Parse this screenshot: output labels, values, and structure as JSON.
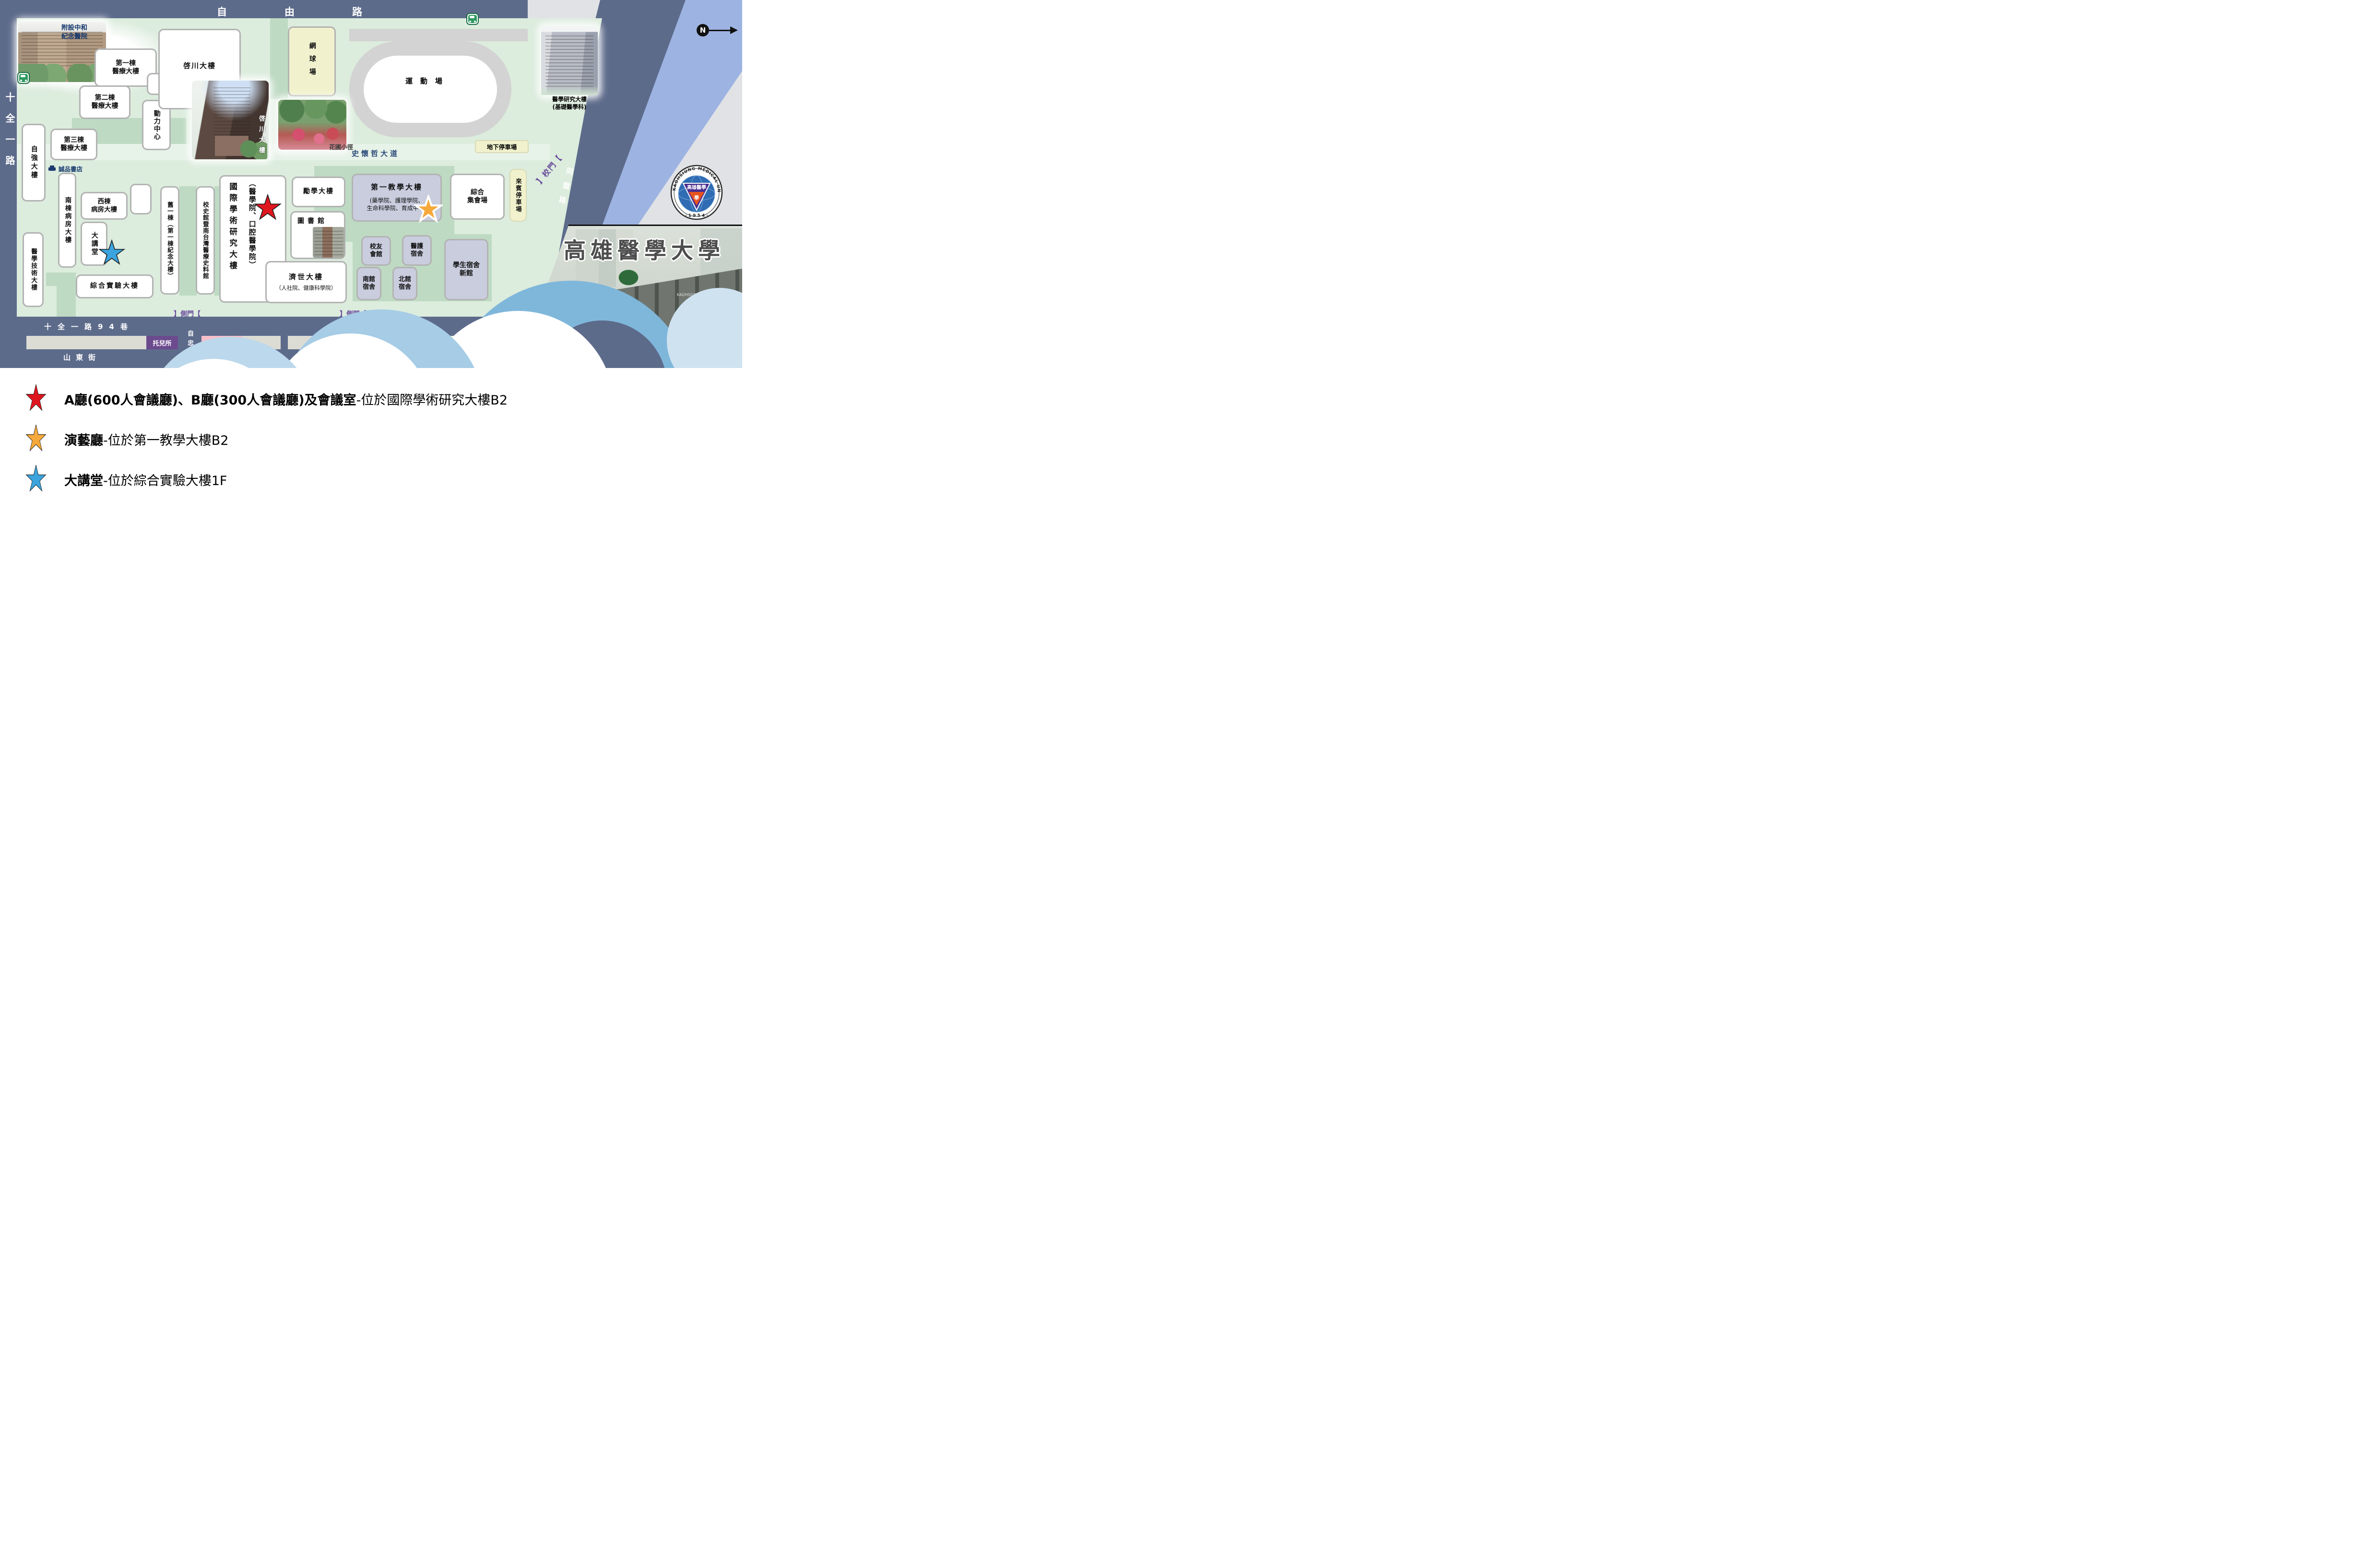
{
  "colors": {
    "road": "#5d6b8b",
    "campus_green": "#dcecdd",
    "path_green": "#bedac3",
    "building_white": "#ffffff",
    "building_lavender": "#c9cdde",
    "parking_yellow": "#f1f2cd",
    "gate_purple": "#6b4f9e",
    "nursery_purple": "#6b4a8e",
    "childcare_pink": "#f6c0cb",
    "stripe_blue": "#9db3e2",
    "stripe_gray": "#e0e2e6",
    "star_red": "#e0161f",
    "star_orange": "#f5a93b",
    "star_blue": "#3ba4de"
  },
  "roads": {
    "ziyou": "自由路",
    "shiquan": "十全一路",
    "lane94_left": "十全一路94巷",
    "lane94_right": "十全一路94巷",
    "shandong": "山東街",
    "zizhong": "自忠街",
    "tongmeng": "同盟路",
    "schweitzer": "史懷哲大道",
    "garden_path": "花圃小徑"
  },
  "gates": {
    "main_gate": "】校門【",
    "side_gate_left": "】側門【",
    "side_gate_right": "】側門【"
  },
  "compass": {
    "n": "N"
  },
  "buildings": {
    "hospital": "附設中和\n紀念醫院",
    "b1": "第一棟\n醫療大樓",
    "b2": "第二棟\n醫療大樓",
    "b3": "第三棟\n醫療大樓",
    "ziqiang": "自強大樓",
    "power": "動力中心",
    "qichuan": "啓川大樓",
    "qichuan_photo": "啓川大樓",
    "tennis": "網球場",
    "stadium": "運動場",
    "med_research": "醫學研究大樓\n(基礎醫學科)",
    "eslite": "誠品書店",
    "south_ward": "南棟病房大樓",
    "west_ward": "西棟\n病房大樓",
    "auditorium": "大講堂",
    "med_tech": "醫學技術大樓",
    "general_lab": "綜合實驗大樓",
    "old_first": "舊一棟（第一棟紀念大樓）",
    "history_museum": "校史館暨南台灣醫療史料館",
    "intl_research": "國際學術研究大樓",
    "intl_research_sub": "（醫學院、口腔醫學院）",
    "lixue": "勵學大樓",
    "library": "圖書館",
    "first_teaching": "第一教學大樓",
    "first_teaching_sub": "(藥學院、護理學院、\n生命科學院、育成中心)",
    "assembly": "綜合\n集會場",
    "jishi": "濟世大樓",
    "jishi_sub": "（人社院、健康科學院）",
    "alumni": "校友\n會館",
    "nurse_dorm": "醫護\n宿舍",
    "south_dorm": "南館\n宿舍",
    "north_dorm": "北館\n宿舍",
    "new_dorm": "學生宿舍\n新館"
  },
  "parking": {
    "underground": "地下停車場",
    "guest": "來賓停車場",
    "hechuan": "和川停車場",
    "nursery": "托兒所",
    "childcare": "托育中心"
  },
  "branding": {
    "seal_arc": "KAOHSIUNG MEDICAL UNIVERSITY",
    "seal_year": "· 1 9 5 4 ·",
    "seal_triangle": "高雄醫學",
    "seal_core": "學",
    "title": "高雄醫學大學",
    "gate_sign": "高雄醫學大學",
    "gate_sign_en": "KAOHSIUNG M"
  },
  "legend": {
    "items": [
      {
        "star": "red",
        "bold": "A廳(600人會議廳)、B廳(300人會議廳)及會議室",
        "rest": "-位於國際學術研究大樓B2"
      },
      {
        "star": "orange",
        "bold": "演藝廳",
        "rest": "-位於第一教學大樓B2"
      },
      {
        "star": "blue",
        "bold": "大講堂",
        "rest": "-位於綜合實驗大樓1F"
      }
    ]
  }
}
